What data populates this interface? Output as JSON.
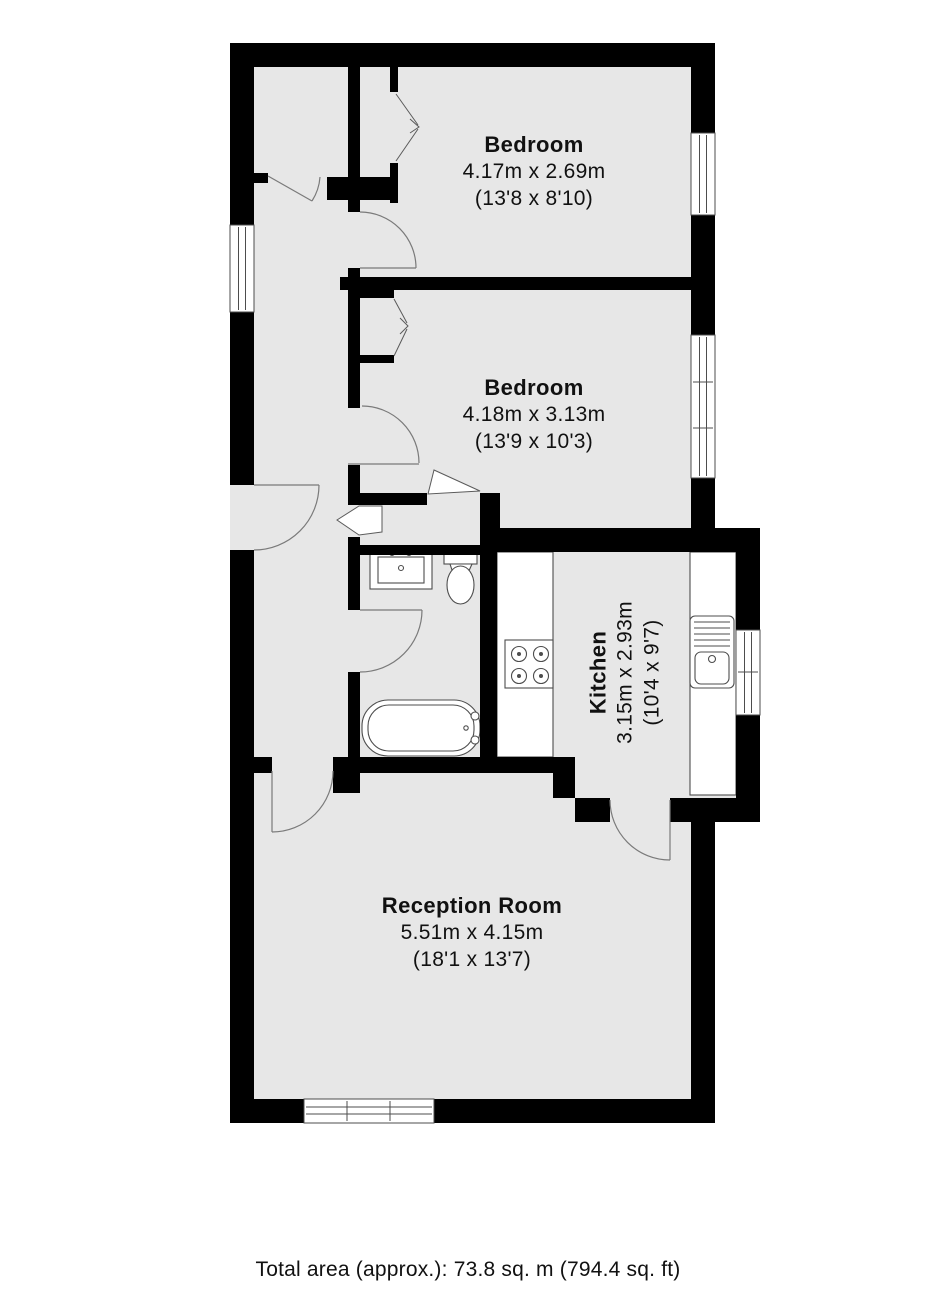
{
  "floorplan": {
    "rooms": [
      {
        "name": "Bedroom",
        "metric": "4.17m x 2.69m",
        "imperial": "(13'8 x 8'10)"
      },
      {
        "name": "Bedroom",
        "metric": "4.18m x 3.13m",
        "imperial": "(13'9 x 10'3)"
      },
      {
        "name": "Kitchen",
        "metric": "3.15m x 2.93m",
        "imperial": "(10'4 x 9'7)"
      },
      {
        "name": "Reception Room",
        "metric": "5.51m x 4.15m",
        "imperial": "(18'1 x 13'7)"
      }
    ],
    "total_area_label": "Total area (approx.): 73.8 sq. m (794.4 sq. ft)",
    "fixtures": [
      "bathtub",
      "toilet",
      "washbasin",
      "hob",
      "kitchen-sink"
    ],
    "window_count": 5,
    "colors": {
      "wall": "#000000",
      "floor": "#e7e7e7",
      "fixture_outline": "#4d4d4d",
      "door_swing": "#7a7a7a",
      "text": "#111111",
      "background": "#ffffff"
    }
  }
}
